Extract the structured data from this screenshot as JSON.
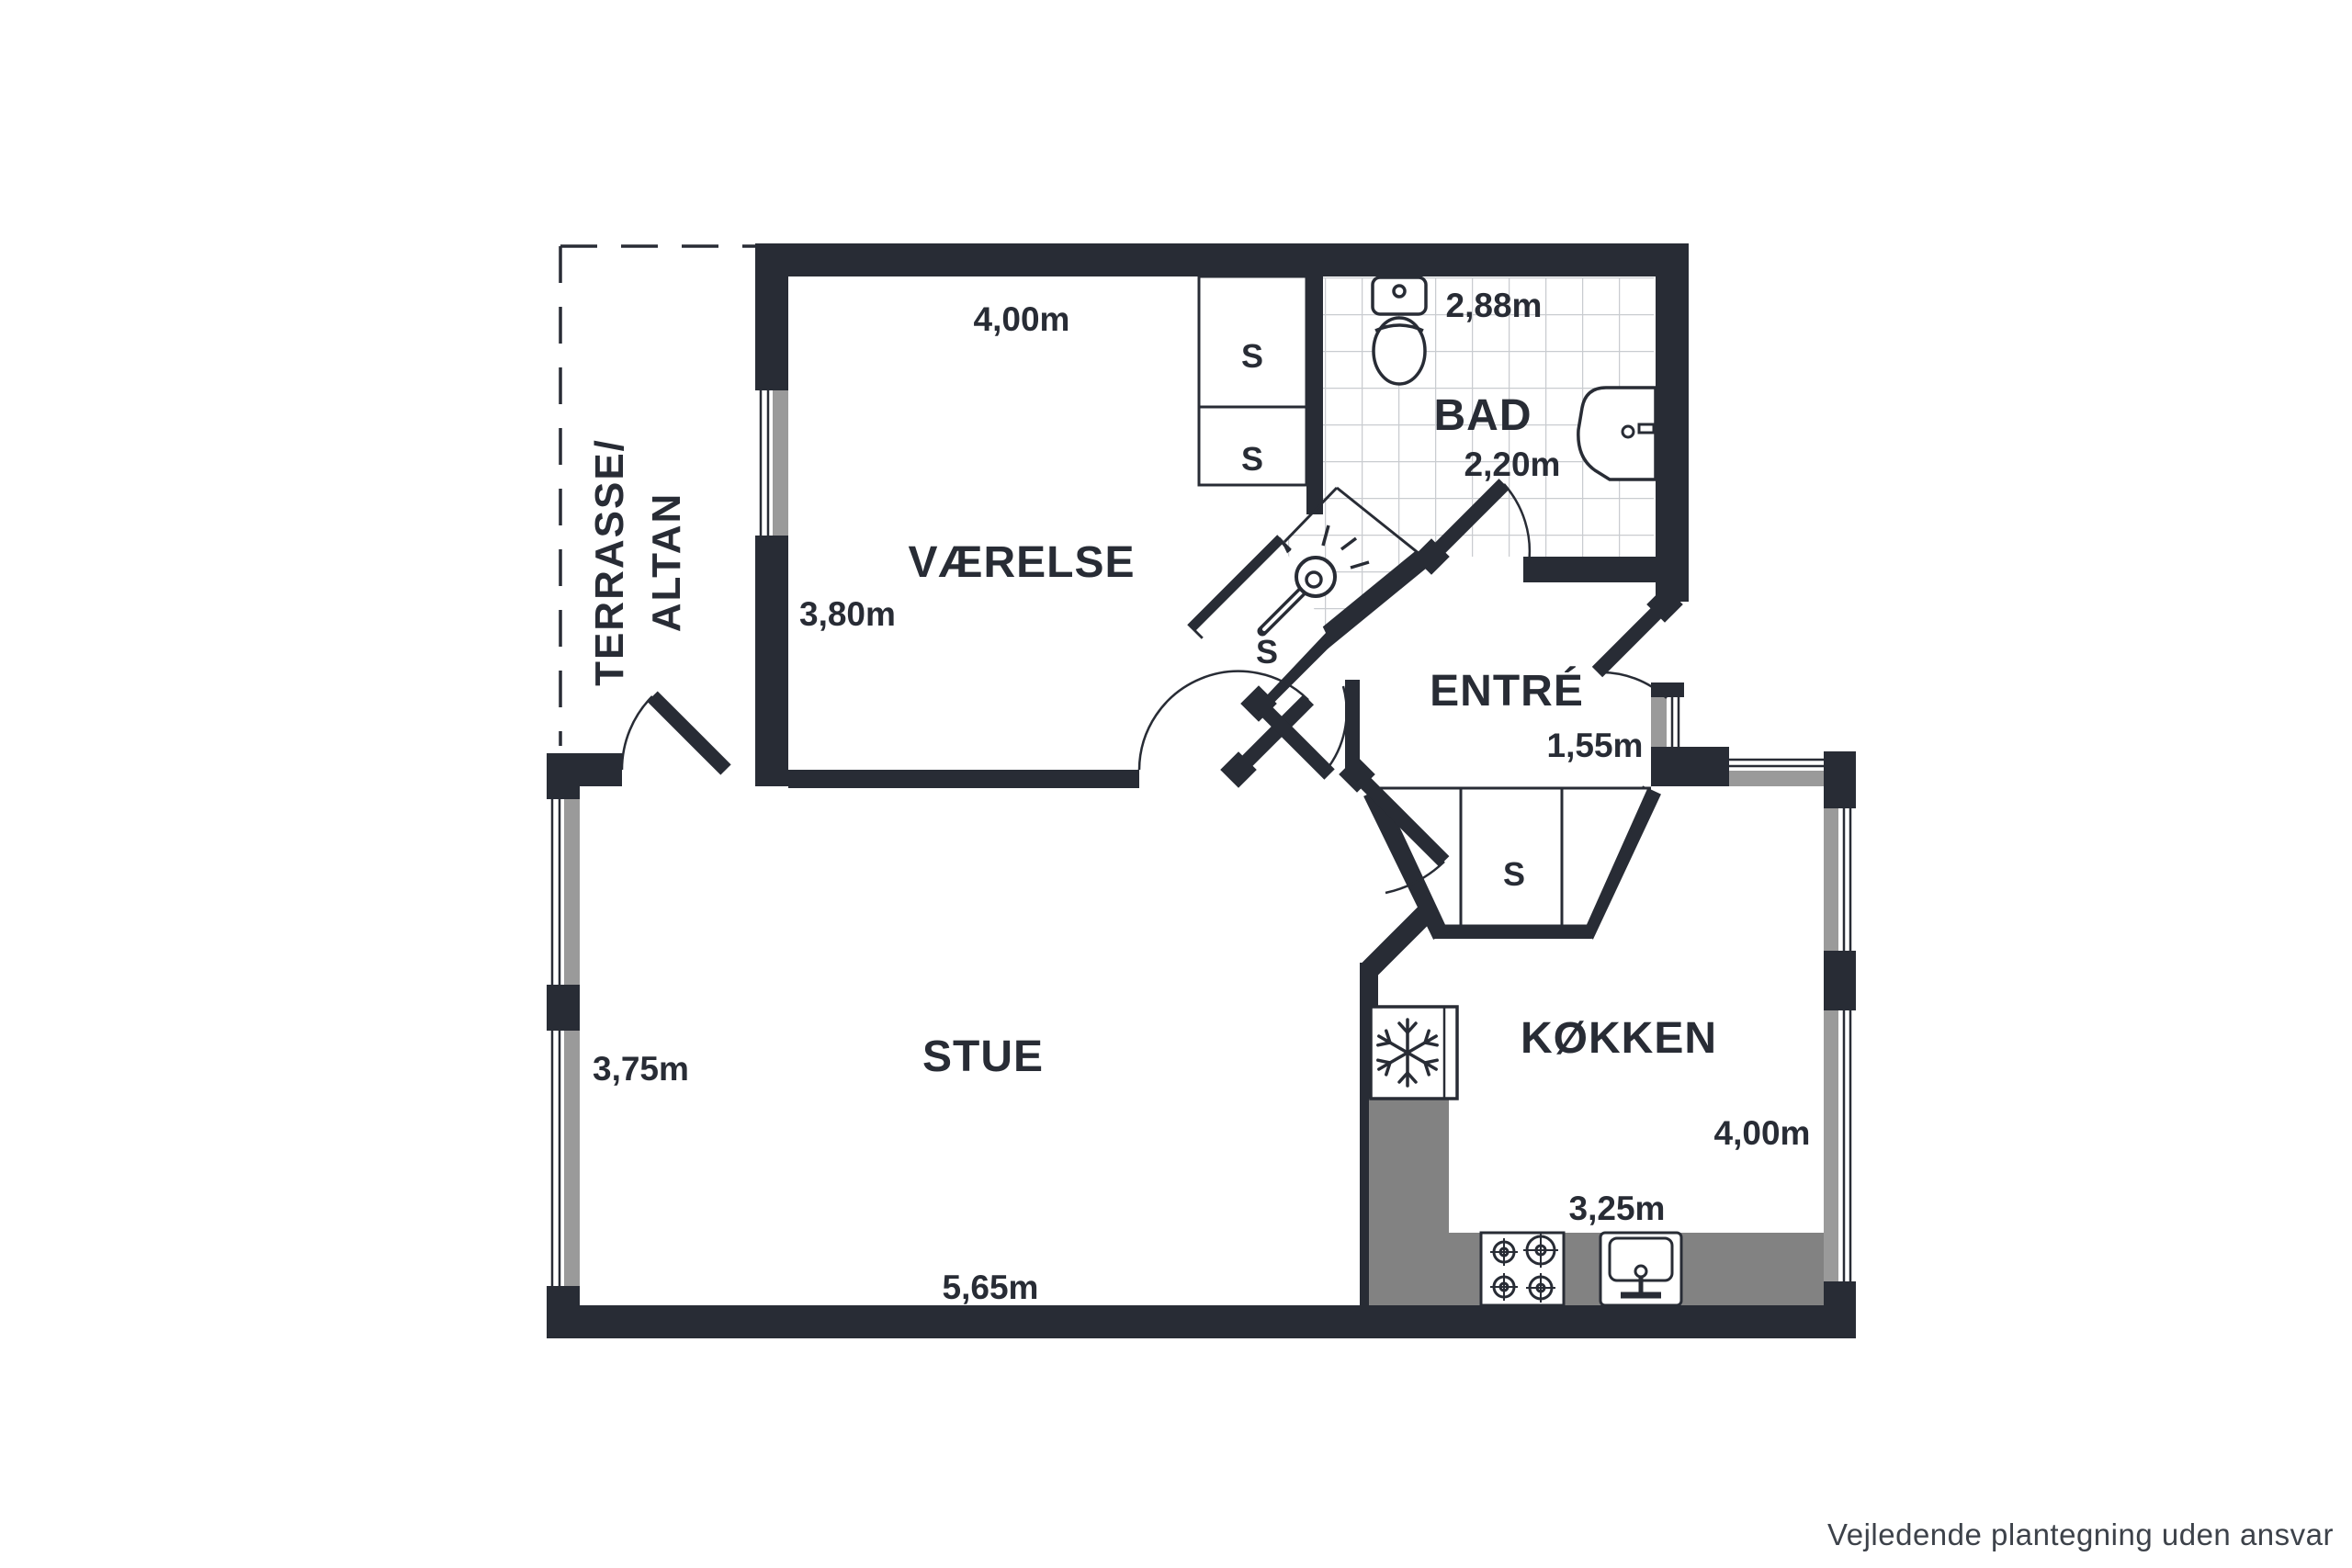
{
  "disclaimer": "Vejledende plantegning uden ansvar",
  "labels": {
    "closet": "S"
  },
  "rooms": {
    "terrace": {
      "name_line1": "TERRASSE/",
      "name_line2": "ALTAN"
    },
    "bedroom": {
      "name": "VÆRELSE",
      "width": "4,00m",
      "depth": "3,80m"
    },
    "bath": {
      "name": "BAD",
      "width": "2,88m",
      "depth": "2,20m"
    },
    "entry": {
      "name": "ENTRÉ",
      "width": "1,55m"
    },
    "living": {
      "name": "STUE",
      "depth": "3,75m",
      "width": "5,65m"
    },
    "kitchen": {
      "name": "KØKKEN",
      "depth": "4,00m",
      "width": "3,25m"
    }
  },
  "colors": {
    "wall": "#282c35",
    "window_glass_gray": "#9a9a9a",
    "kitchen_counter_gray": "#828282",
    "tile_line": "#c9ccd0",
    "disclaimer_text": "#3d424a"
  }
}
